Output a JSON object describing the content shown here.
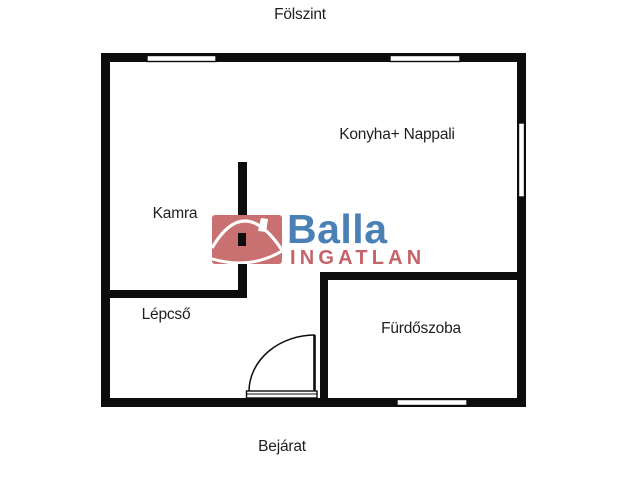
{
  "plan": {
    "title": "Fölszint",
    "entrance_label": "Bejárat"
  },
  "rooms": [
    {
      "name": "Konyha+ Nappali"
    },
    {
      "name": "Kamra"
    },
    {
      "name": "Lépcső"
    },
    {
      "name": "Fürdőszoba"
    }
  ],
  "logo": {
    "brand": "Balla",
    "subtitle": "INGATLAN",
    "brand_color": "#4a80b6",
    "subtitle_color": "#c5636a",
    "icon_color": "#c97070",
    "icon_name": "balla-house-icon"
  },
  "colors": {
    "wall": "#0d0d0d",
    "background": "#ffffff",
    "label": "#1f1f1f"
  }
}
